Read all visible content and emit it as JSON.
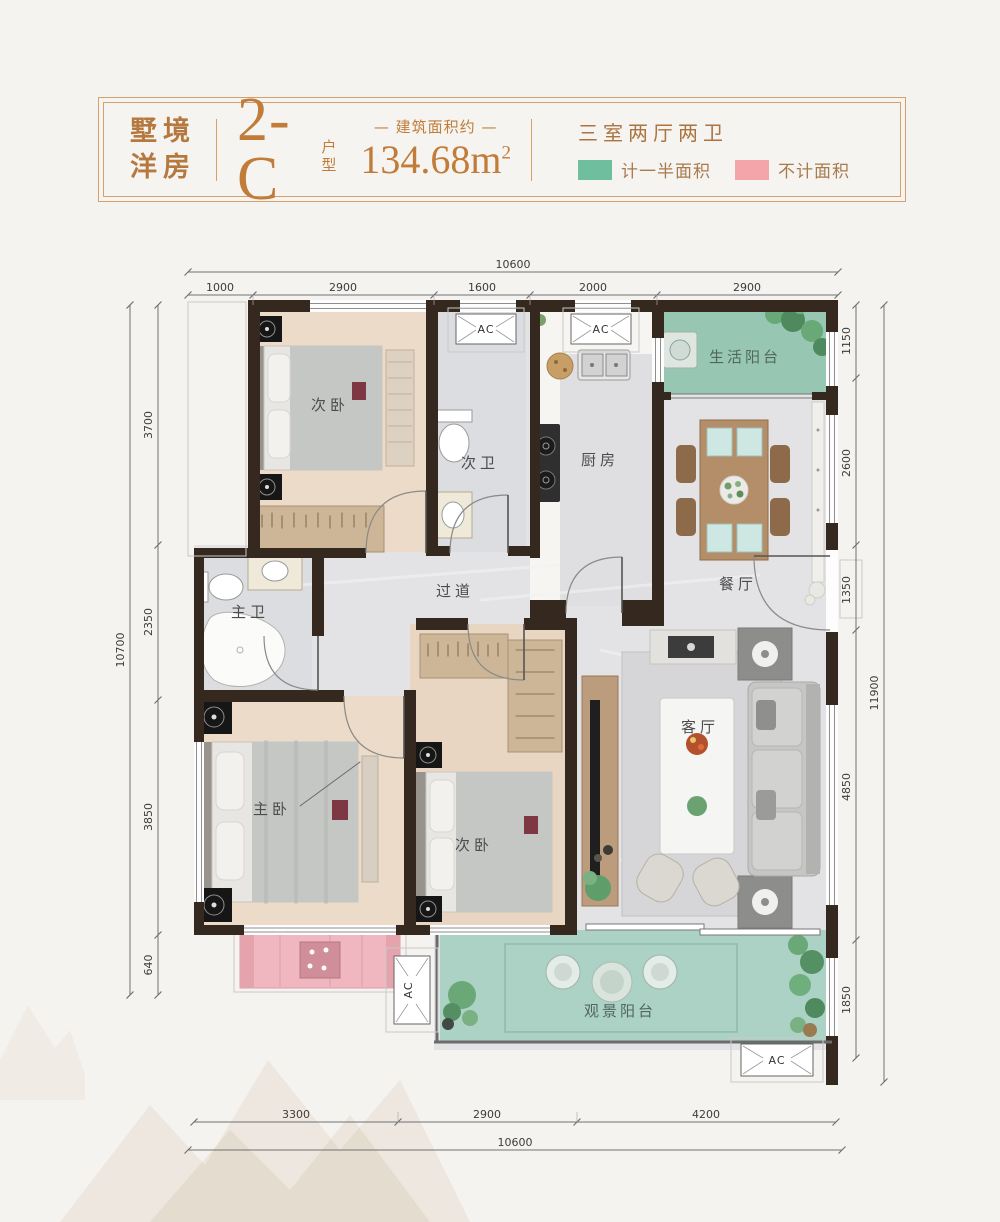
{
  "header": {
    "brand": [
      "墅境",
      "洋房"
    ],
    "unit_code": "2-C",
    "unit_type": [
      "户",
      "型"
    ],
    "area_label": "— 建筑面积约 —",
    "area_value": "134.68m",
    "area_exponent": "2",
    "layout_desc": "三室两厅两卫",
    "legend_half_label": "计一半面积",
    "legend_none_label": "不计面积",
    "colors": {
      "accent": "#c07c38",
      "half_area_green": "#6fbf9e",
      "no_area_pink": "#f4a5aa",
      "wall": "#35291f"
    }
  },
  "rooms": {
    "bedroom_top": "次卧",
    "bath_second": "次卫",
    "kitchen": "厨房",
    "life_balcony": "生活阳台",
    "dining": "餐厅",
    "corridor": "过道",
    "bath_master": "主卫",
    "bedroom_master": "主卧",
    "bedroom_second": "次卧",
    "living": "客厅",
    "view_balcony": "观景阳台"
  },
  "ac": "AC",
  "dims": {
    "top": {
      "total": "10600",
      "segments": [
        "1000",
        "2900",
        "1600",
        "2000",
        "2900"
      ]
    },
    "left": {
      "total": "10700",
      "segments": [
        "3700",
        "2350",
        "3850",
        "640"
      ]
    },
    "right": {
      "total": "11900",
      "segments": [
        "1150",
        "2600",
        "1350",
        "4850",
        "1850"
      ]
    },
    "bottom": {
      "total": "10600",
      "segments": [
        "3300",
        "2900",
        "4200"
      ]
    }
  }
}
